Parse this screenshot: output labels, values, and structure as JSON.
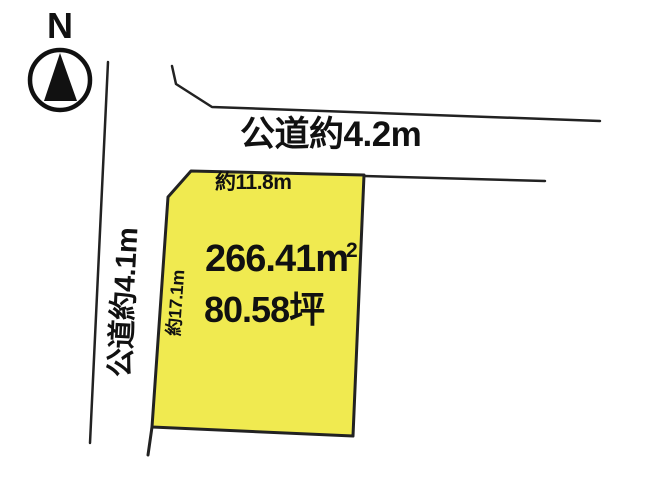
{
  "compass": {
    "north_label": "N"
  },
  "roads": {
    "top_label": "公道約4.2m",
    "left_label": "公道約4.1m"
  },
  "parcel": {
    "area_value": "266.41",
    "area_unit": "m",
    "area_unit_exponent": "2",
    "area_tsubo": "80.58坪",
    "top_edge_length": "約11.8m",
    "left_edge_length": "約17.1m"
  },
  "colors": {
    "parcel_fill": "#f0ea50",
    "line": "#222222",
    "background": "#ffffff"
  }
}
